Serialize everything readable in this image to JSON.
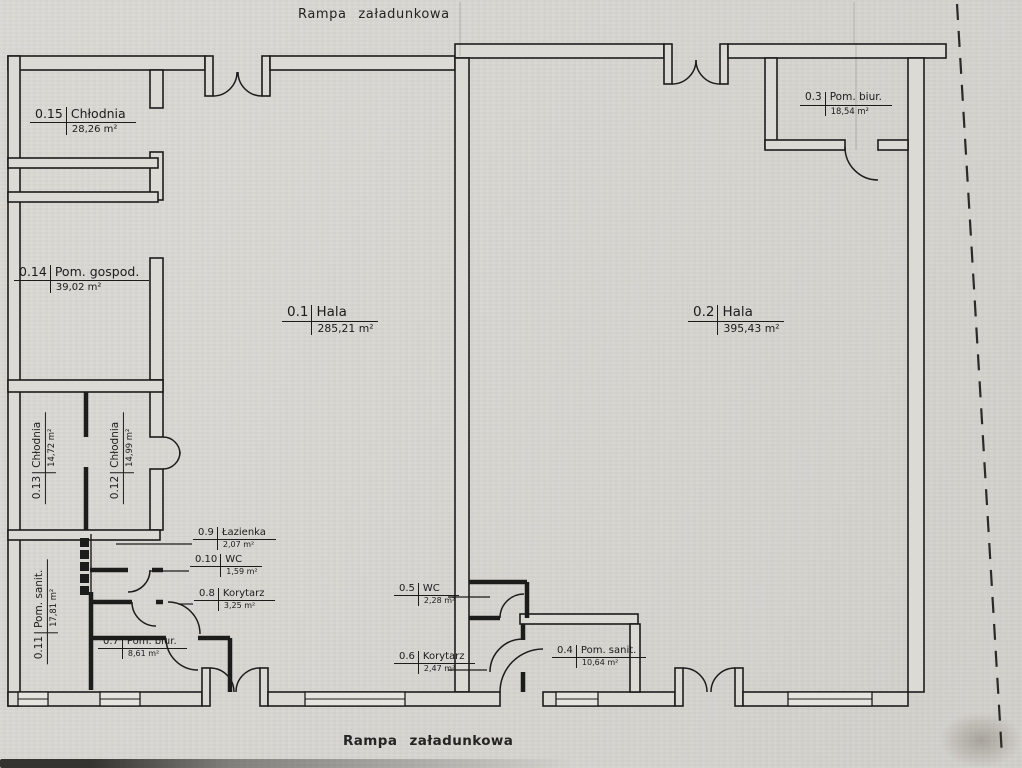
{
  "plan": {
    "top_caption": "Rampa załadunkowa",
    "bottom_caption": "Rampa załadunkowa"
  },
  "rooms": [
    {
      "number": "0.15",
      "name": "Chłodnia",
      "area": "28,26 m²"
    },
    {
      "number": "0.14",
      "name": "Pom. gospod.",
      "area": "39,02 m²"
    },
    {
      "number": "0.1",
      "name": "Hala",
      "area": "285,21 m²"
    },
    {
      "number": "0.2",
      "name": "Hala",
      "area": "395,43 m²"
    },
    {
      "number": "0.3",
      "name": "Pom. biur.",
      "area": "18,54 m²"
    },
    {
      "number": "0.13",
      "name": "Chłodnia",
      "area": "14,72 m²"
    },
    {
      "number": "0.12",
      "name": "Chłodnia",
      "area": "14,99 m²"
    },
    {
      "number": "0.11",
      "name": "Pom. sanit.",
      "area": "17,81 m²"
    },
    {
      "number": "0.9",
      "name": "Łazienka",
      "area": "2,07 m²"
    },
    {
      "number": "0.10",
      "name": "WC",
      "area": "1,59 m²"
    },
    {
      "number": "0.8",
      "name": "Korytarz",
      "area": "3,25 m²"
    },
    {
      "number": "0.7",
      "name": "Pom. biur.",
      "area": "8,61 m²"
    },
    {
      "number": "0.5",
      "name": "WC",
      "area": "2,28 m²"
    },
    {
      "number": "0.6",
      "name": "Korytarz",
      "area": "2,47 m²"
    },
    {
      "number": "0.4",
      "name": "Pom. sanit.",
      "area": "10,64 m²"
    }
  ],
  "colors": {
    "paper": "#d8d6d1",
    "ink": "#1f1f1e"
  }
}
